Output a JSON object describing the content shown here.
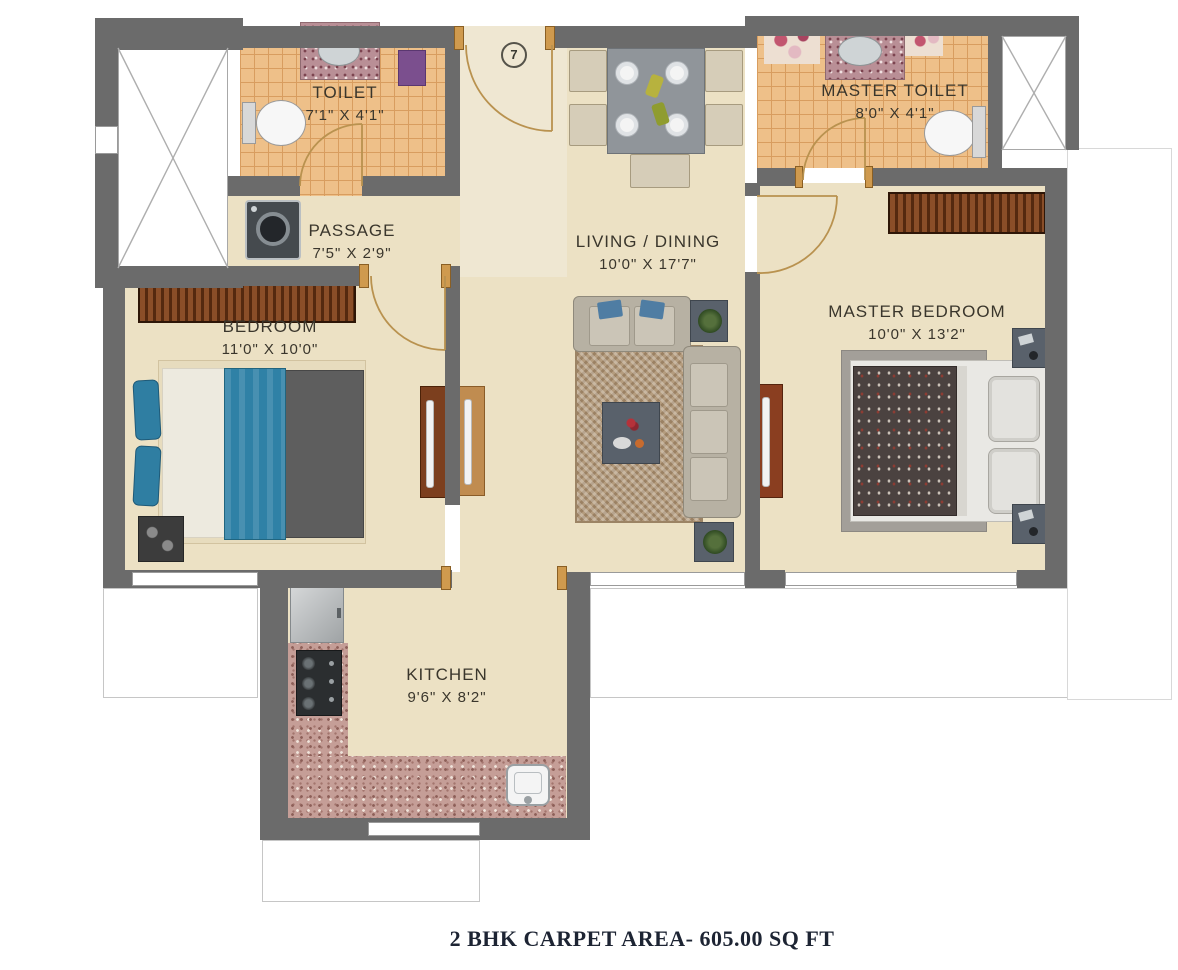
{
  "unit_number": "7",
  "caption": "2 BHK CARPET AREA- 605.00 SQ FT",
  "rooms": [
    {
      "id": "toilet",
      "name": "TOILET",
      "dims": "7'1\" X 4'1\""
    },
    {
      "id": "master_toilet",
      "name": "MASTER TOILET",
      "dims": "8'0\" X 4'1\""
    },
    {
      "id": "passage",
      "name": "PASSAGE",
      "dims": "7'5\" X 2'9\""
    },
    {
      "id": "living_dining",
      "name": "LIVING / DINING",
      "dims": "10'0\" X 17'7\""
    },
    {
      "id": "bedroom",
      "name": "BEDROOM",
      "dims": "11'0\" X 10'0\""
    },
    {
      "id": "master_bedroom",
      "name": "MASTER BEDROOM",
      "dims": "10'0\" X 13'2\""
    },
    {
      "id": "kitchen",
      "name": "KITCHEN",
      "dims": "9'6\" X 8'2\""
    }
  ],
  "colors": {
    "wall": "#6b6b6b",
    "floor": "#ece1c4",
    "toilet_tile": "#eec089",
    "granite_counter": "#c59e97",
    "wood_furniture": "#7c3f1e",
    "bed_teal": "#2f81a6",
    "door_arc": "#b9924f",
    "caption_text": "#1d2433"
  }
}
